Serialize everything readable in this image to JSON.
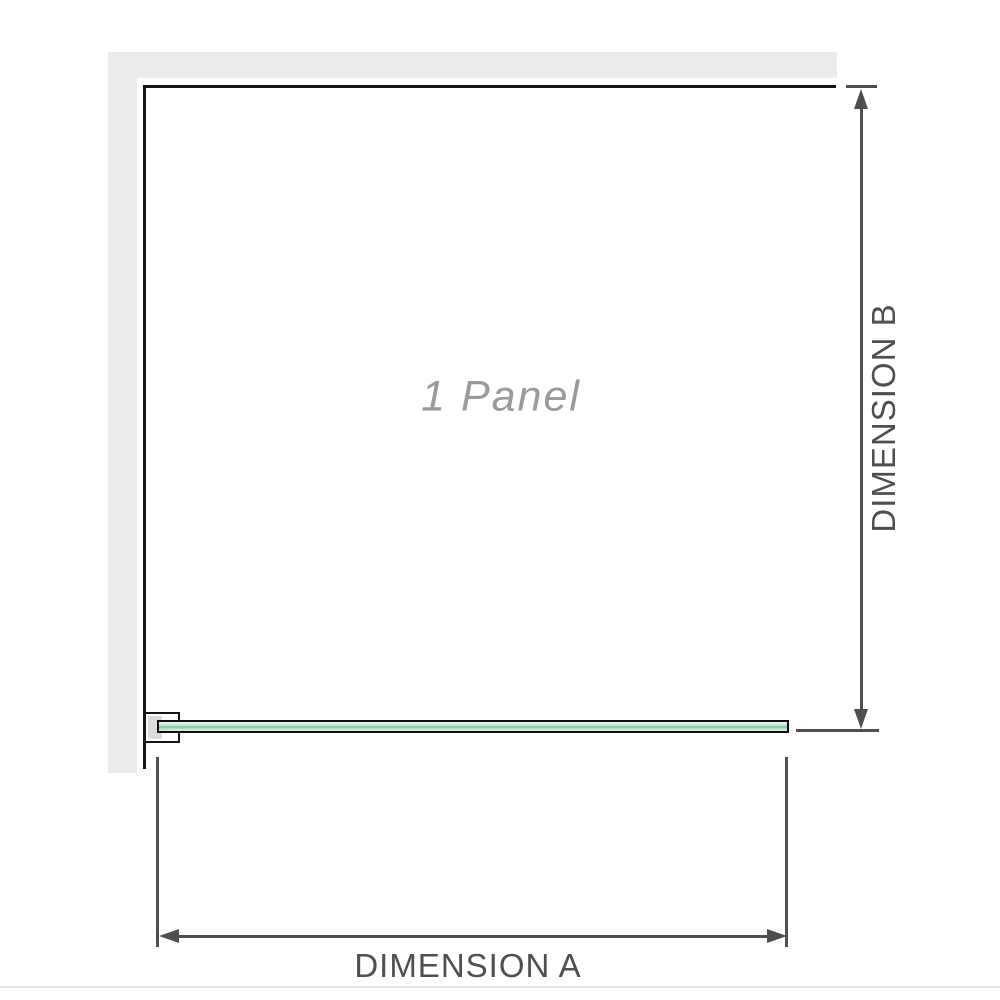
{
  "diagram": {
    "panel_label": "1 Panel",
    "dimension_a_label": "DIMENSION A",
    "dimension_b_label": "DIMENSION B"
  },
  "icons": {
    "dimension_b_arrows": "double-headed vertical arrow",
    "dimension_a_arrows": "double-headed horizontal arrow"
  },
  "colors": {
    "wall": "#ececec",
    "structure": "#151515",
    "dim": "#4f4f4f",
    "label_gray": "#9a9a9a",
    "glass_light": "#eaf7f0",
    "glass_mid": "#c6e8d6",
    "glass_dark": "#7cc59e",
    "glass_low": "#dcf1e6",
    "bracket_fill": "#dcdcdc",
    "divider": "#e8e5e0"
  }
}
